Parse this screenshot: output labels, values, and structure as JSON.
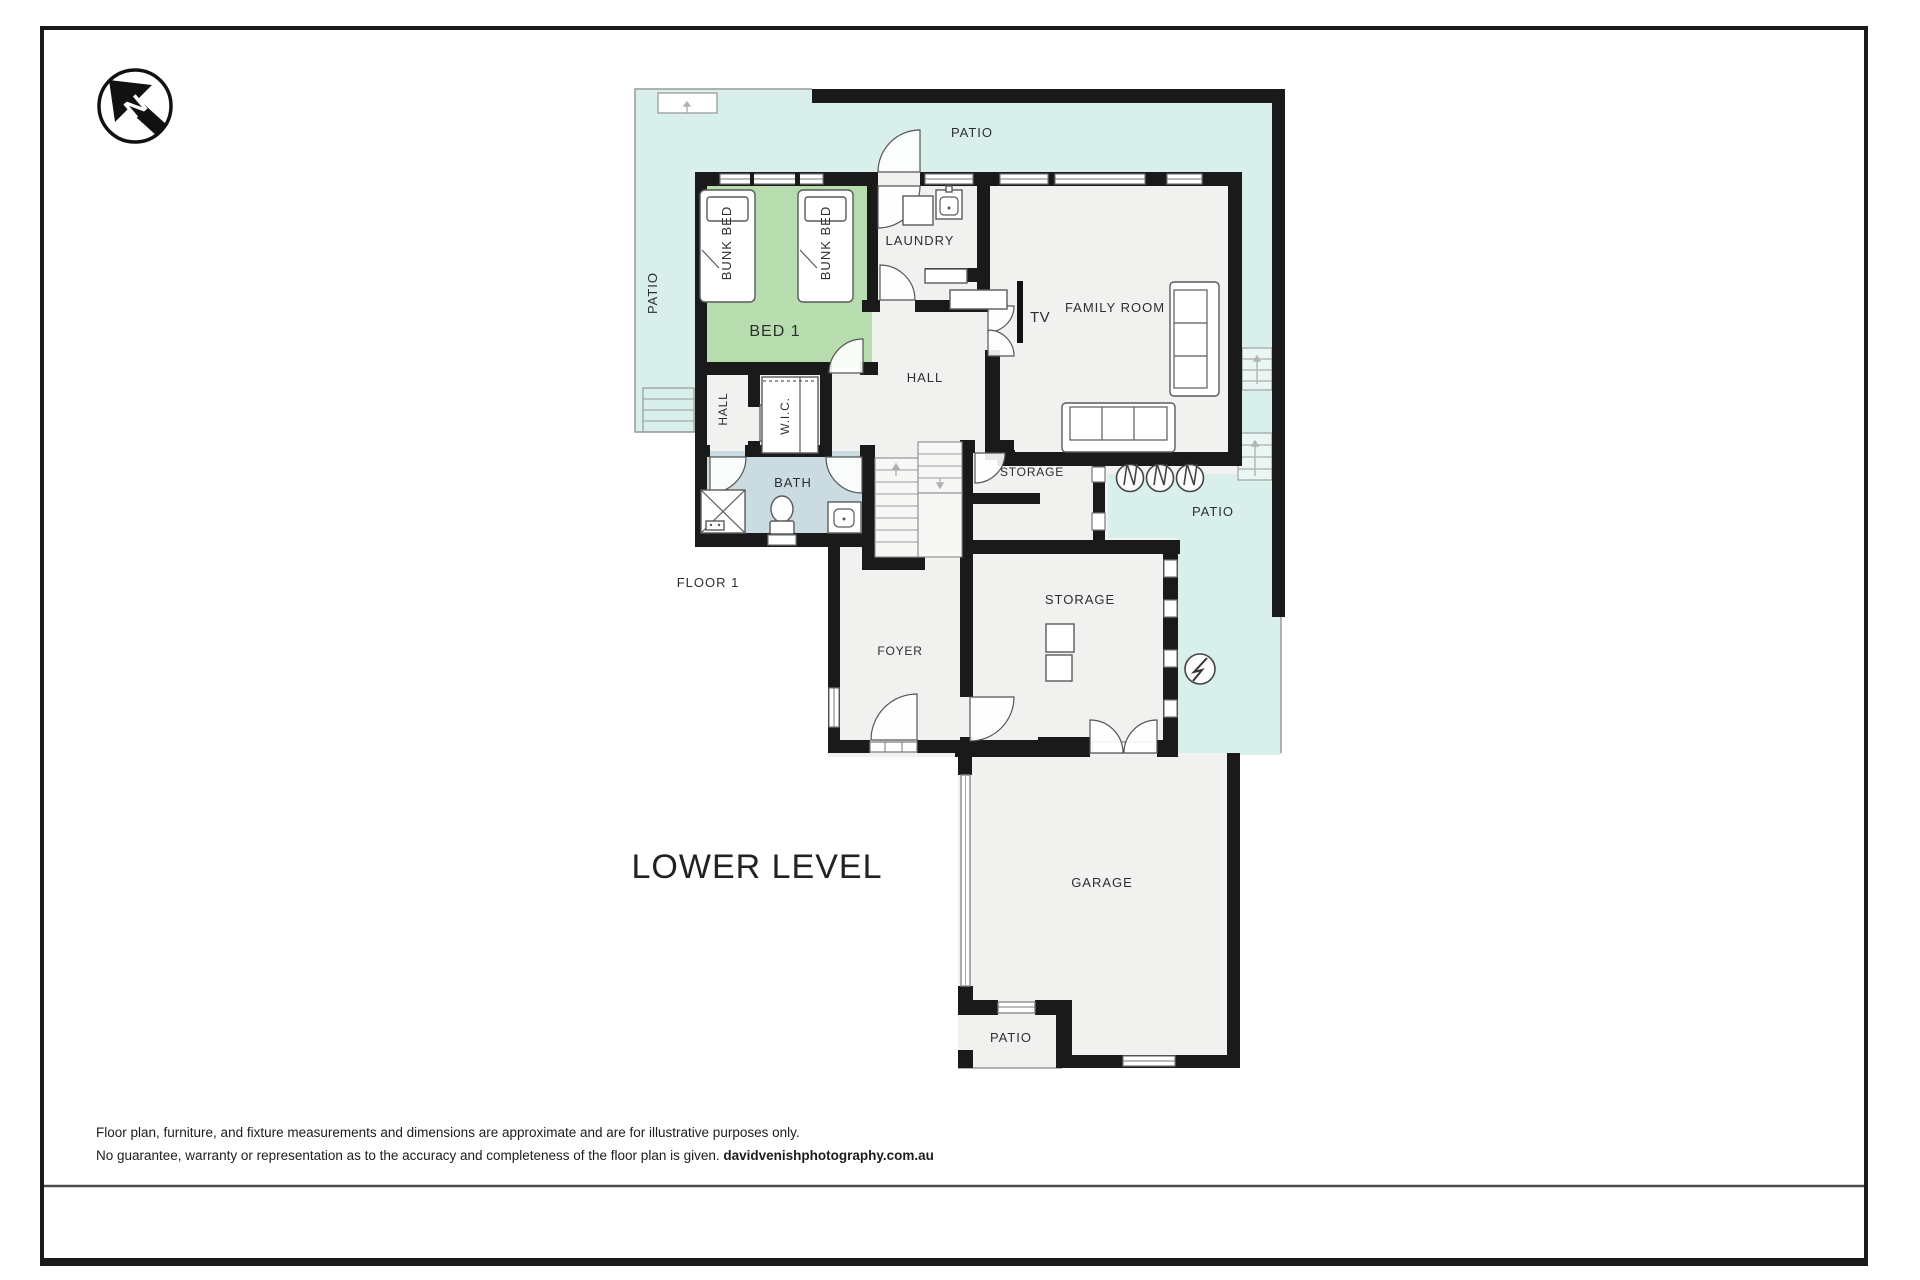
{
  "colors": {
    "wall": "#1a1a1a",
    "patio_fill": "#d9efec",
    "room_fill": "#f1f2ef",
    "bedroom_fill": "#b7dcae",
    "bath_fill": "#cadbe2",
    "outline": "#999999",
    "text": "#2e2e2e"
  },
  "plan": {
    "title": "LOWER LEVEL",
    "floor_label": "FLOOR 1",
    "compass_letter": "N",
    "rooms": {
      "patio_top": "PATIO",
      "patio_left": "PATIO",
      "patio_right": "PATIO",
      "patio_bottom": "PATIO",
      "bed1": "BED 1",
      "bunk_bed": "BUNK BED",
      "laundry": "LAUNDRY",
      "family_room": "FAMILY ROOM",
      "tv": "TV",
      "hall": "HALL",
      "hall_small": "HALL",
      "wic": "W.I.C.",
      "bath": "BATH",
      "storage_upper": "STORAGE",
      "storage_lower": "STORAGE",
      "foyer": "FOYER",
      "garage": "GARAGE"
    }
  },
  "footer": {
    "disclaimer_line1": "Floor plan, furniture, and fixture measurements and dimensions are approximate and are for illustrative purposes only.",
    "disclaimer_line2": "No guarantee, warranty or representation as to the accuracy and completeness of the floor plan is given. ",
    "credit": "davidvenishphotography.com.au"
  }
}
